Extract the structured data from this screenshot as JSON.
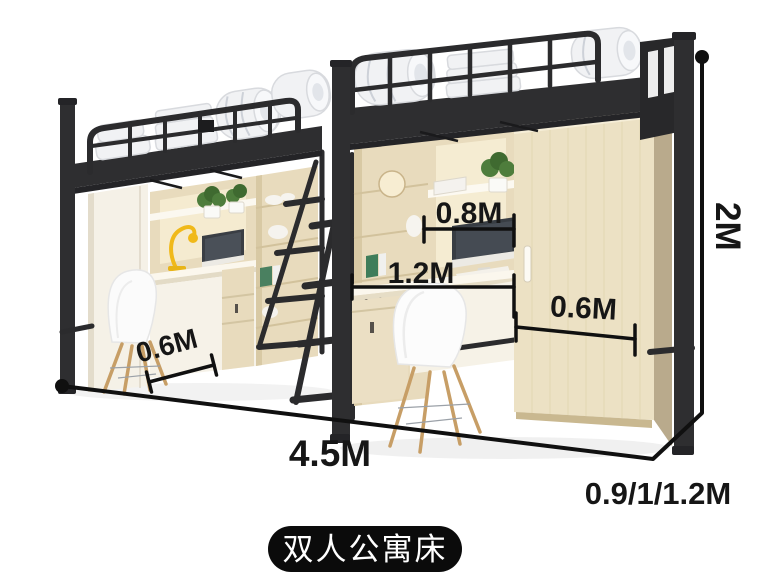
{
  "badge": {
    "label": "双人公寓床"
  },
  "dimensions": {
    "height": "2M",
    "total_length": "4.5M",
    "bed_width_options": "0.9/1/1.2M",
    "hutch_width": "0.8M",
    "desk_length": "1.2M",
    "chair_clearance": "0.6M",
    "wardrobe_depth": "0.6M"
  },
  "colors": {
    "frame_metal": "#2e2e30",
    "wood_light": "#e8dbbd",
    "annotation": "#101010",
    "badge_background": "#0b0b0b",
    "badge_text": "#ffffff",
    "lamp_accent": "#f0b91a",
    "plant_green": "#4e7d3c"
  }
}
